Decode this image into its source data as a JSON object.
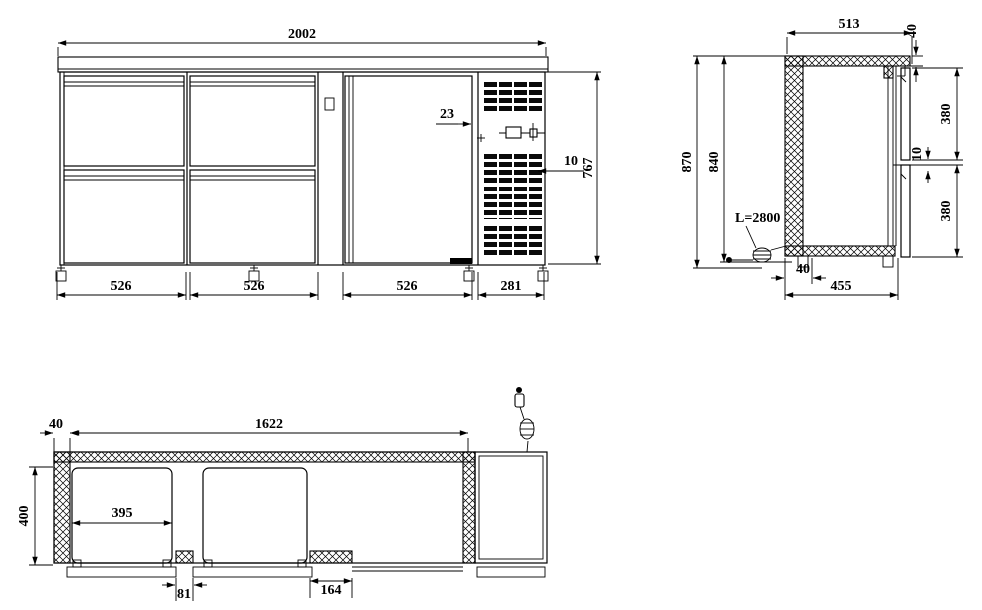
{
  "front": {
    "total_width": "2002",
    "col_widths": [
      "526",
      "526",
      "526"
    ],
    "vent_width": "281",
    "body_height": "767",
    "door_gap": "23",
    "grille_thickness": "10"
  },
  "side": {
    "top_depth": "513",
    "worktop_thickness": "40",
    "overall_height": "870",
    "case_height": "840",
    "upper_drawer_height": "380",
    "drawer_gap": "10",
    "lower_drawer_height": "380",
    "cable_length": "L=2800",
    "foot_offset": "40",
    "base_depth": "455"
  },
  "plan": {
    "wall_thickness": "40",
    "inner_width": "1622",
    "inner_depth": "400",
    "drawer_opening": "395",
    "gap_small": "81",
    "gap_large": "164"
  }
}
